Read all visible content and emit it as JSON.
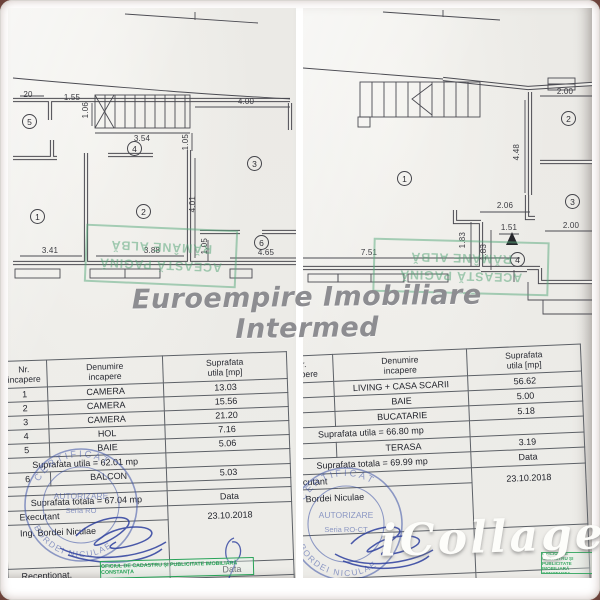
{
  "watermark": {
    "text": "Euroempire Imobiliare Intermed"
  },
  "brand": {
    "text": "iCollage"
  },
  "page_stamp": {
    "line1": "ACEASTĂ PAGINĂ",
    "line2": "RĂMÂNE ALBĂ"
  },
  "stamps": {
    "office": "OFICIUL DE CADASTRU ȘI PUBLICITATE IMOBILIARĂ CONSTANȚA",
    "cert_top": "CERTIFICAT",
    "cert_mid1": "AUTORIZARE",
    "cert_mid2": "Seria RO",
    "cert_name": "BORDEI NICULAE"
  },
  "left_plan": {
    "rooms": {
      "r1": "1",
      "r2": "2",
      "r3": "3",
      "r4": "4",
      "r5": "5",
      "r6": "6"
    },
    "dims": {
      "d20": "20",
      "d155": "1.55",
      "d106": "1.06",
      "d354": "3.54",
      "d400": "4.00",
      "d105a": "1.05",
      "d401": "4.01",
      "d341": "3.41",
      "d388": "3.88",
      "d105b": "1.05",
      "d465": "4.65"
    }
  },
  "right_plan": {
    "rooms": {
      "r1": "1",
      "r2": "2",
      "r3": "3",
      "r4": "4"
    },
    "dims": {
      "d200a": "2.00",
      "d448": "4.48",
      "d206": "2.06",
      "d151": "1.51",
      "d183a": "1.83",
      "d183b": "1.83",
      "d200b": "2.00",
      "d751": "7.51"
    }
  },
  "left_table": {
    "header": {
      "nr": "Nr.\nincapere",
      "name": "Denumire\nincapere",
      "area": "Suprafata\nutila [mp]"
    },
    "rows": [
      {
        "nr": "1",
        "name": "CAMERA",
        "area": "13.03"
      },
      {
        "nr": "2",
        "name": "CAMERA",
        "area": "15.56"
      },
      {
        "nr": "3",
        "name": "CAMERA",
        "area": "21.20"
      },
      {
        "nr": "4",
        "name": "HOL",
        "area": "7.16"
      },
      {
        "nr": "5",
        "name": "BAIE",
        "area": "5.06"
      }
    ],
    "subtotal": "Suprafata utila = 62.01 mp",
    "extra_row": {
      "nr": "6",
      "name": "BALCON",
      "area": "5.03"
    },
    "total": "Suprafata totala = 67.04 mp",
    "data_label": "Data",
    "executant_label": "Executant",
    "date": "23.10.2018",
    "engineer": "Ing. Bordei Niculae",
    "receptionat_label": "Receptionat,",
    "data_label2": "Data"
  },
  "right_table": {
    "header": {
      "nr": "Nr.\nincapere",
      "name": "Denumire\nincapere",
      "area": "Suprafata\nutila [mp]"
    },
    "rows": [
      {
        "nr": "",
        "name": "LIVING + CASA SCARII",
        "area": "56.62"
      },
      {
        "nr": "",
        "name": "BAIE",
        "area": "5.00"
      },
      {
        "nr": "",
        "name": "BUCATARIE",
        "area": "5.18"
      }
    ],
    "subtotal": "Suprafata utila = 66.80 mp",
    "extra_row": {
      "nr": "",
      "name": "TERASA",
      "area": "3.19"
    },
    "total": "Suprafata totala = 69.99 mp",
    "data_label": "Data",
    "executant_label": "Executant",
    "date": "23.10.2018",
    "engineer": "Ing. Bordei Niculae",
    "receptionat_label": "Receptionat"
  }
}
